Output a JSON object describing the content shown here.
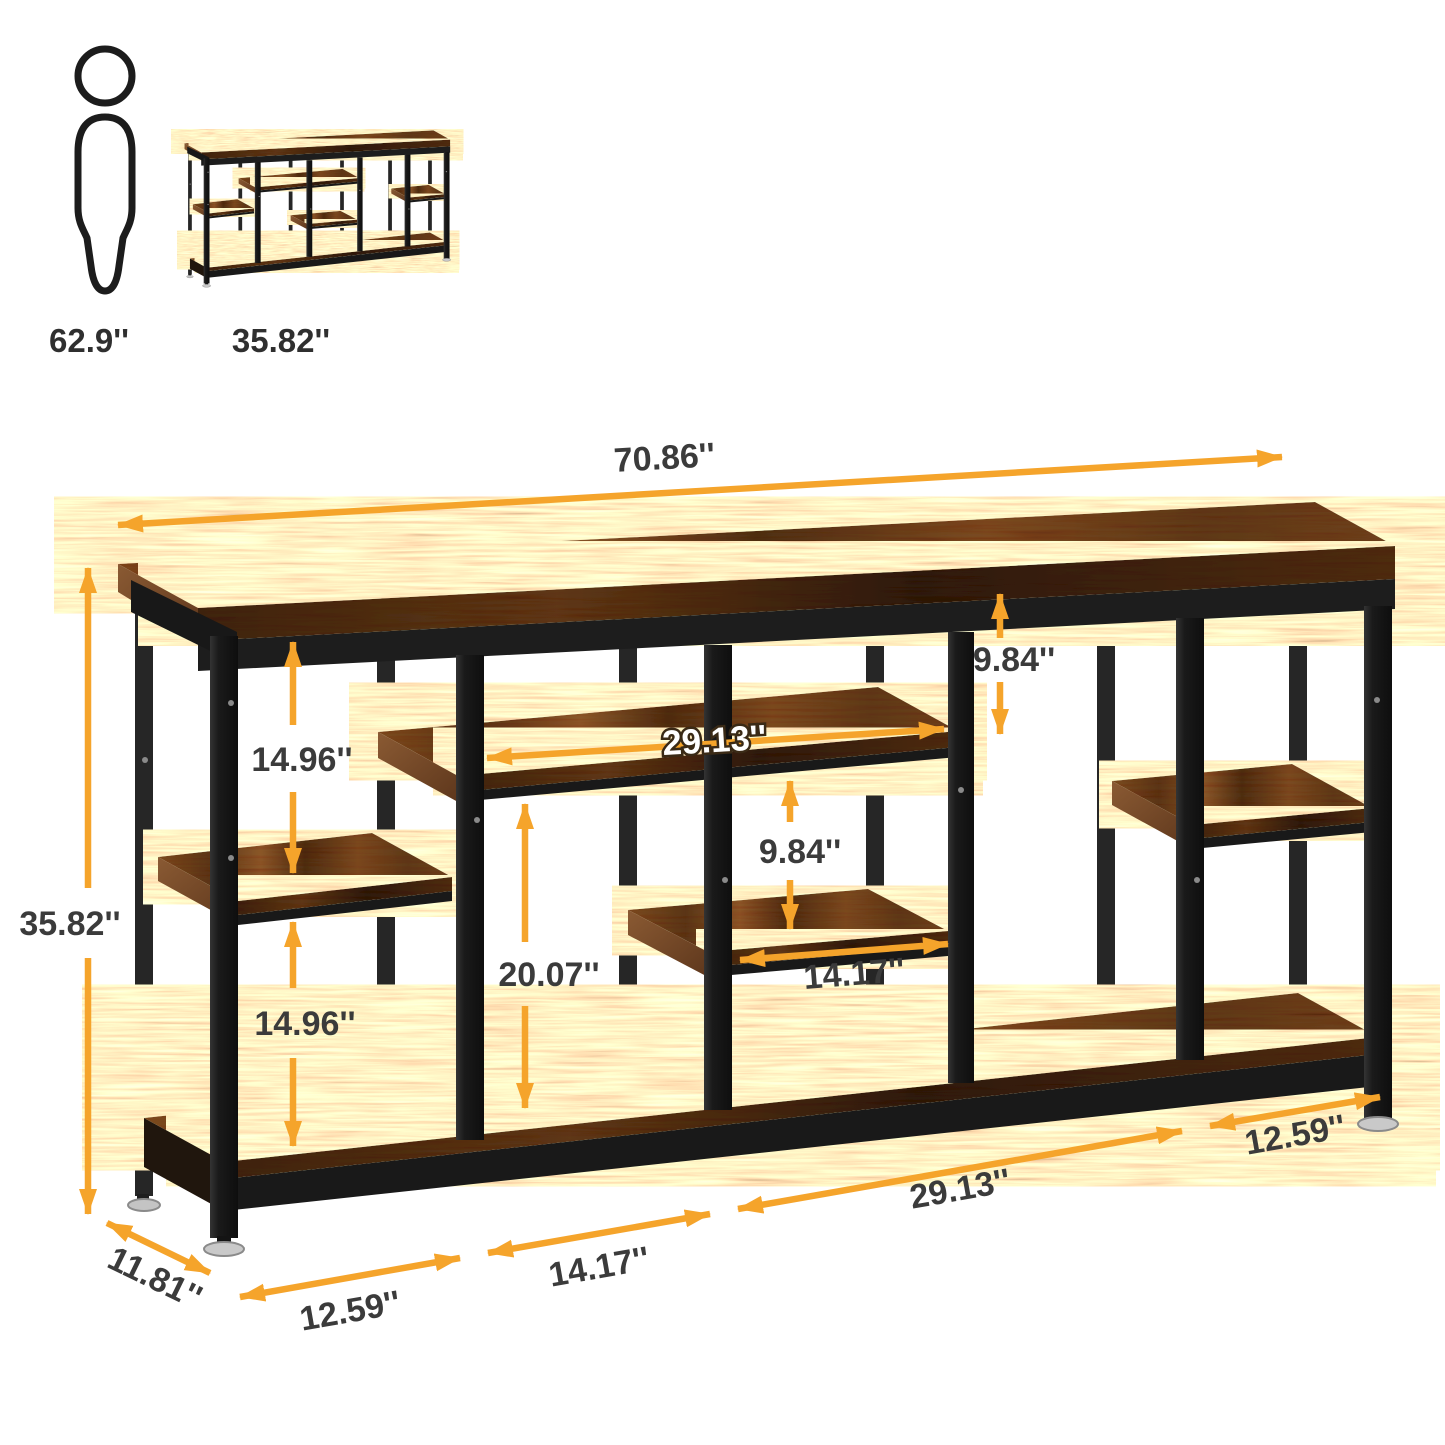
{
  "scale_reference": {
    "person_height": "62.9''",
    "product_height": "35.82''"
  },
  "annotations": {
    "top_width": "70.86''",
    "overall_height": "35.82''",
    "upper_left_gap": "14.96''",
    "lower_left_gap": "14.96''",
    "middle_shelf_width": "29.13''",
    "top_right_gap": "9.84''",
    "middle_gap": "9.84''",
    "lower_middle_height": "20.07''",
    "middle_lower_shelf_width": "14.17''",
    "bottom_bay_1": "12.59''",
    "bottom_bay_2": "14.17''",
    "bottom_bay_3": "29.13''",
    "bottom_bay_4": "12.59''",
    "depth": "11.81''"
  },
  "colors": {
    "accent_arrow": "#F5A42B",
    "label_text": "#3B3B3B",
    "wood_base": "#6B4226",
    "metal_frame": "#1C1C1C",
    "background": "#FFFFFF"
  }
}
